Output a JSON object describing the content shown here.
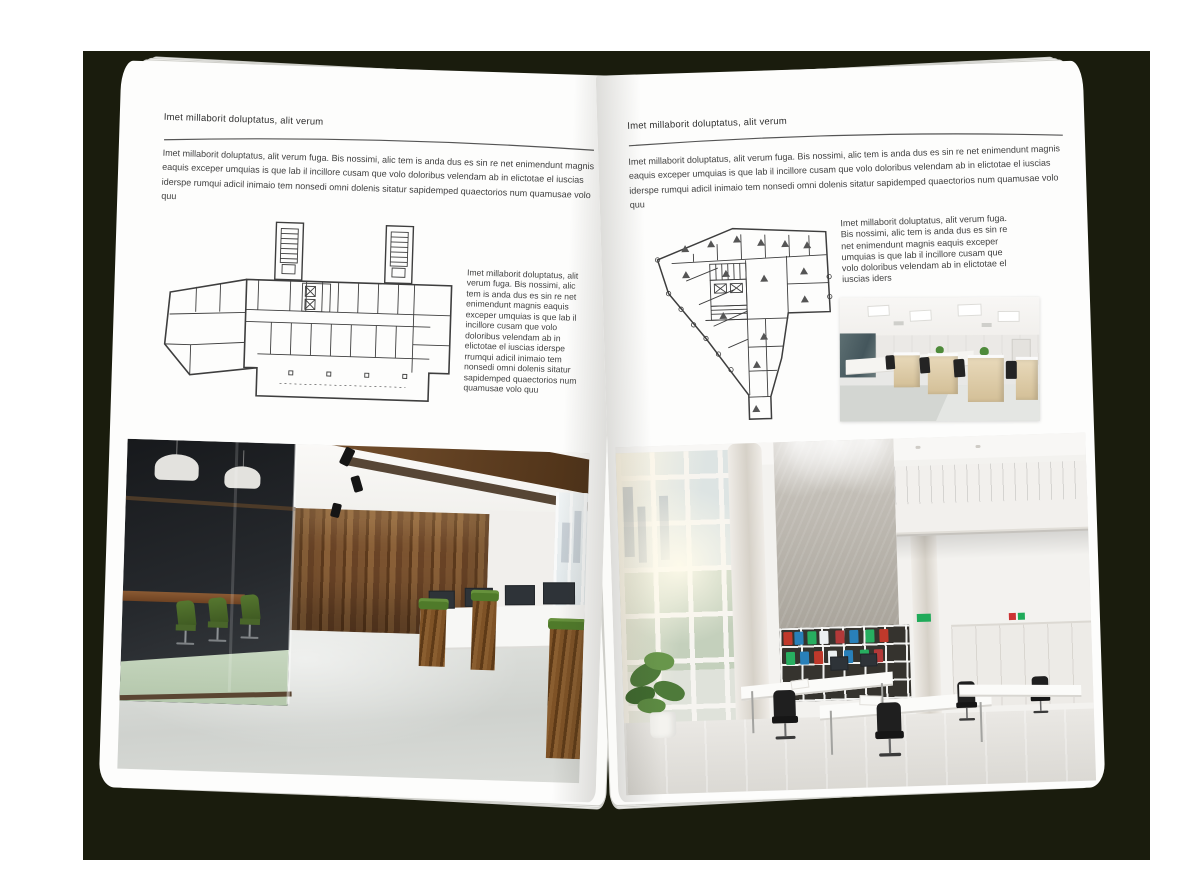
{
  "colors": {
    "backdrop": "#1a1c0d",
    "paper": "#fdfdfc",
    "body_text": "#3f3f3f",
    "heading_text": "#2f2f2f",
    "rule": "#555555",
    "plan_line": "#3e3e3e"
  },
  "book": {
    "left_page": {
      "header": "Imet millaborit doluptatus, alit verum",
      "intro": "Imet millaborit doluptatus, alit verum fuga. Bis nossimi, alic tem is anda dus es sin re net enimendunt magnis eaquis exceper umquias is que lab il incillore cusam que volo doloribus velendam ab in elictotae el iuscias iderspe rumqui adicil inimaio tem nonsedi omni dolenis sitatur sapidemped quaectorios num quamusae volo quu",
      "side_text": "Imet millaborit doluptatus, alit verum fuga. Bis nossimi, alic tem is anda dus es sin re net enimendunt magnis eaquis exceper umquias is que lab il incillore cusam que volo doloribus velendam ab in elictotae el iuscias iderspe rrumqui adicil inimaio tem nonsedi omni dolenis sitatur sapidemped quaectorios num quamusae volo quu",
      "floorplan_label": "architectural-floor-plan-with-two-stair-towers",
      "photo_label": "dark-wood-open-office-with-glass-meeting-room"
    },
    "right_page": {
      "header": "Imet millaborit doluptatus, alit verum",
      "intro": "Imet millaborit doluptatus, alit verum fuga. Bis nossimi, alic tem is anda dus es sin re net enimendunt magnis eaquis exceper umquias is que lab il incillore cusam que volo doloribus velendam ab in elictotae el iuscias iderspe rumqui adicil inimaio tem nonsedi omni dolenis sitatur sapidemped quaectorios num quamusae volo quu",
      "side_text": "Imet millaborit doluptatus, alit verum fuga. Bis nossimi, alic tem is anda dus es sin re net enimendunt magnis eaquis exceper umquias is que lab il incillore cusam que volo doloribus velendam ab in elictotae el iuscias iders",
      "floorplan_label": "architectural-floor-plan-irregular-corner-building",
      "small_photo_label": "open-plan-office-workstation-rows",
      "photo_label": "bright-double-height-office-atrium"
    }
  }
}
